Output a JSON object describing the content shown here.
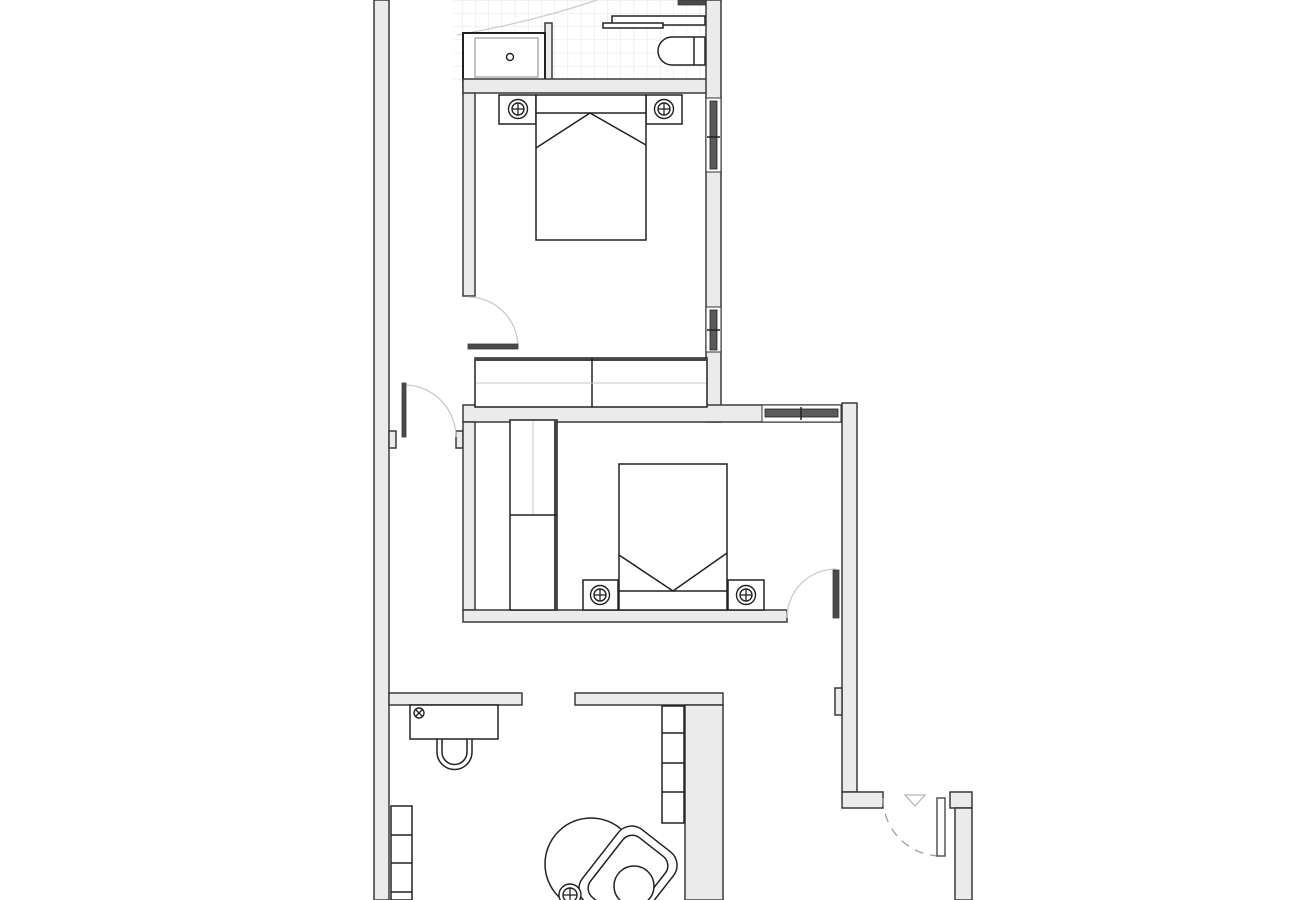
{
  "meta": {
    "title": "Apartment floor plan — top view architectural drawing",
    "drawing_type": "floor-plan",
    "canvas": {
      "width": 1300,
      "height": 900
    }
  },
  "colors": {
    "background": "#ffffff",
    "wall_fill": "#ebebeb",
    "wall_line": "#3a3a3a",
    "furniture_line": "#222222",
    "dark_element": "#4a4a4a",
    "swing_arc": "#cccccc",
    "tile_line": "#e4e4e4",
    "entry_arc": "#999999",
    "marker": "#b8b8b8"
  },
  "rooms": [
    {
      "id": "bathroom",
      "position": "top",
      "features": [
        "tiled-floor",
        "vanity-sink-with-drain",
        "toilet",
        "two-wall-shelves",
        "door-swing-arc",
        "partition-stub"
      ]
    },
    {
      "id": "bedroom-1",
      "position": "upper",
      "features": [
        "double-bed-headboard-up",
        "blanket-fold-lines",
        "left-nightstand",
        "right-nightstand",
        "two-table-lamp-symbols",
        "wide-wardrobe-bottom",
        "window-upper",
        "window-lower",
        "hinged-door-with-arc"
      ]
    },
    {
      "id": "bedroom-2",
      "position": "middle",
      "features": [
        "double-bed-headboard-down",
        "blanket-fold-lines",
        "left-nightstand",
        "right-nightstand",
        "two-table-lamp-symbols",
        "tall-wardrobe-left",
        "window-top-wall",
        "hinged-door-with-arc"
      ]
    },
    {
      "id": "hallway",
      "position": "left-and-right-spine",
      "features": [
        "corridor-door-with-arc",
        "door-jambs",
        "wall-niche",
        "entrance-door",
        "entrance-dashed-swing",
        "entrance-triangle-marker"
      ]
    },
    {
      "id": "living-area",
      "position": "bottom",
      "features": [
        "wall-mounted-desk",
        "desk-screw-symbol",
        "desk-chair",
        "armchair-round",
        "floor-lamp-symbol",
        "shelving-left-wall",
        "shelving-column",
        "service-column"
      ]
    }
  ],
  "window_count": 4,
  "door_count": 5,
  "lamp_symbol_count": 5
}
